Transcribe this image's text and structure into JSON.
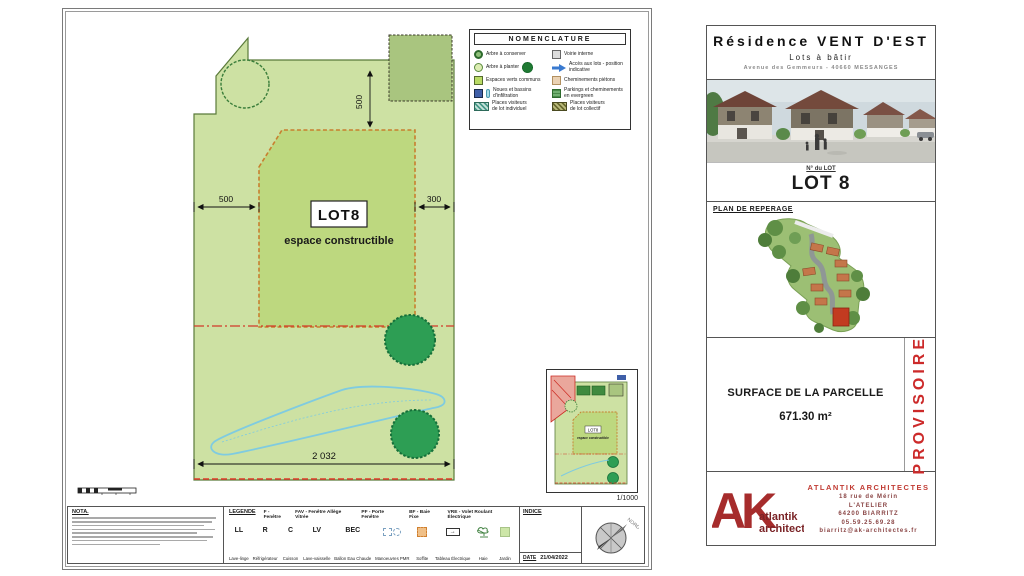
{
  "sheet": {
    "nomenclature": {
      "title": "NOMENCLATURE",
      "left": [
        {
          "label": "Arbre à conserver"
        },
        {
          "label": "Arbre à planter"
        },
        {
          "label": "Espaces verts communs"
        },
        {
          "label": "Noues et bassins d'infiltration"
        },
        {
          "label": "Places visiteurs\nde lot individuel"
        }
      ],
      "right": [
        {
          "label": "Voirie interne"
        },
        {
          "label": "Accès aux lots - position indicative"
        },
        {
          "label": "Cheminements piétons"
        },
        {
          "label": "Parkings et cheminements en evergreen"
        },
        {
          "label": "Places visiteurs\nde lot collectif"
        }
      ]
    },
    "plan": {
      "lot_label": "LOT8",
      "lot_sublabel": "espace constructible",
      "dim_left": "500",
      "dim_right": "300",
      "dim_vertical": "500",
      "dim_bottom": "2 032",
      "inset_scale": "1/1000"
    },
    "nota_title": "NOTA.",
    "legende": {
      "title": "LEGENDE",
      "defs": [
        "F - Fenêtre",
        "FAV - Fenêtre Allège Vitrée",
        "PF - Porte Fenêtre",
        "BF - Baie Fixe",
        "VRE - Volet Roulant Électrique"
      ],
      "items": [
        {
          "abbr": "LL",
          "name": "Lave-linge"
        },
        {
          "abbr": "R",
          "name": "Réfrigérateur"
        },
        {
          "abbr": "C",
          "name": "Cuisson"
        },
        {
          "abbr": "LV",
          "name": "Lave-vaisselle"
        },
        {
          "abbr": "BEC",
          "name": "Ballon Eau Chaude"
        },
        {
          "name": "Manoeuvres PMR"
        },
        {
          "name": "Soffite"
        },
        {
          "name": "Tableau Électrique"
        },
        {
          "name": "Haie"
        },
        {
          "name": "Jardin"
        }
      ]
    },
    "indice": {
      "label": "INDICE",
      "date_label": "DATE",
      "date_value": "21/04/2022"
    },
    "compass_label": "NORD"
  },
  "panel": {
    "title": "Résidence VENT D'EST",
    "subtitle": "Lots à bâtir",
    "address": "Avenue des Gemmeurs - 40660 MESSANGES",
    "lot_number_label": "N° du LOT",
    "lot_number": "LOT 8",
    "map_title": "PLAN DE REPERAGE",
    "surface_label": "SURFACE DE LA PARCELLE",
    "surface_value": "671.30 m²",
    "status": "PROVISOIRE",
    "architect": {
      "logo_monogram": "AK",
      "logo_line1": "atlantik",
      "logo_line2": "architectes",
      "name": "ATLANTIK ARCHITECTES",
      "address1": "18 rue de Mérin",
      "address2": "L'ATELIER",
      "address3": "64200 BIARRITZ",
      "phone": "05.59.25.69.28",
      "email": "biarritz@ak-architectes.fr"
    }
  }
}
